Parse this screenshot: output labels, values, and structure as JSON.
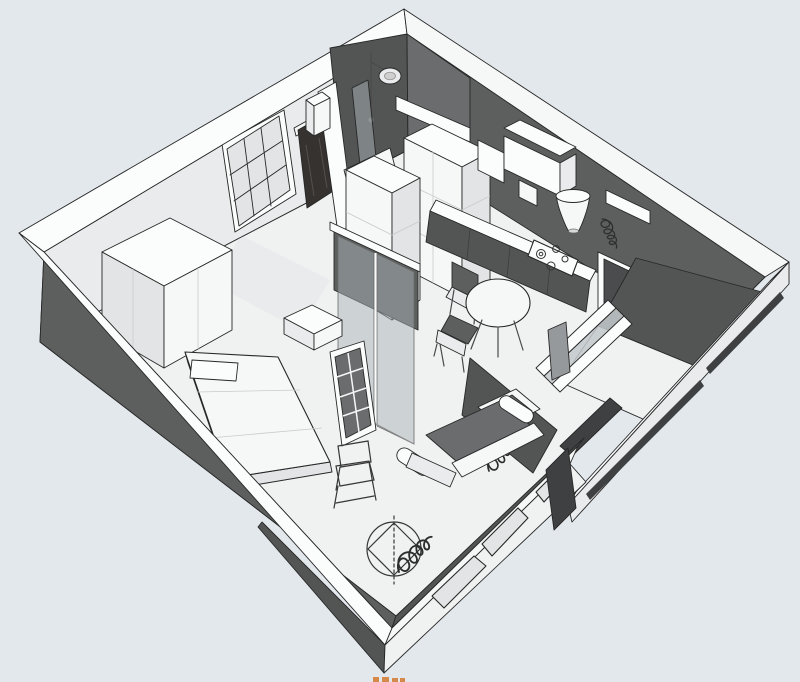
{
  "scene": {
    "label": "Axonometric cutaway 3D render of a one-room apartment floor plan",
    "background": "#e3e8ec",
    "rooms": [
      {
        "name": "entry-hall"
      },
      {
        "name": "bathroom"
      },
      {
        "name": "kitchen"
      },
      {
        "name": "bedroom"
      },
      {
        "name": "living-area"
      },
      {
        "name": "balcony-loggia"
      }
    ],
    "fixtures": [
      "entry-door",
      "glazed-grid-window",
      "wardrobe",
      "shower-set",
      "shower-glass-screen",
      "shower-tray",
      "kitchen-wall-cabinets",
      "cooker-hood-cone",
      "cooktop-4-burners",
      "kitchen-counter",
      "tall-cabinet-column",
      "round-dining-table",
      "dining-chair-dark-back",
      "dining-chair-dark-seat",
      "glass-partition",
      "open-french-door",
      "console-table",
      "double-bed",
      "sofa-l-shaped",
      "metal-frame-chair",
      "sketched-round-stool",
      "kitchen-loggia-window",
      "facade-windows",
      "loggia-parapet"
    ],
    "annotations": [
      {
        "name": "handwritten-scribble-kitchen"
      },
      {
        "name": "handwritten-scribble-wall"
      },
      {
        "name": "handwritten-scribble-floor"
      },
      {
        "name": "orange-watermark-fragment"
      }
    ]
  },
  "colors": {
    "background": "#e3e8ec",
    "wall_white": "#fbfcfc",
    "wall_light": "#f0f1f1",
    "wall_mid": "#e2e4e5",
    "wall_dark": "#5d5f5f",
    "wall_darker": "#4a4c4d",
    "wall_darkest": "#3e4041",
    "floor": "#f0f1f1",
    "entry_door": "#35322f",
    "glass": "#aab3b8",
    "outline": "#272727",
    "scribble": "#2d2d2d",
    "watermark_orange": "#d27930"
  }
}
